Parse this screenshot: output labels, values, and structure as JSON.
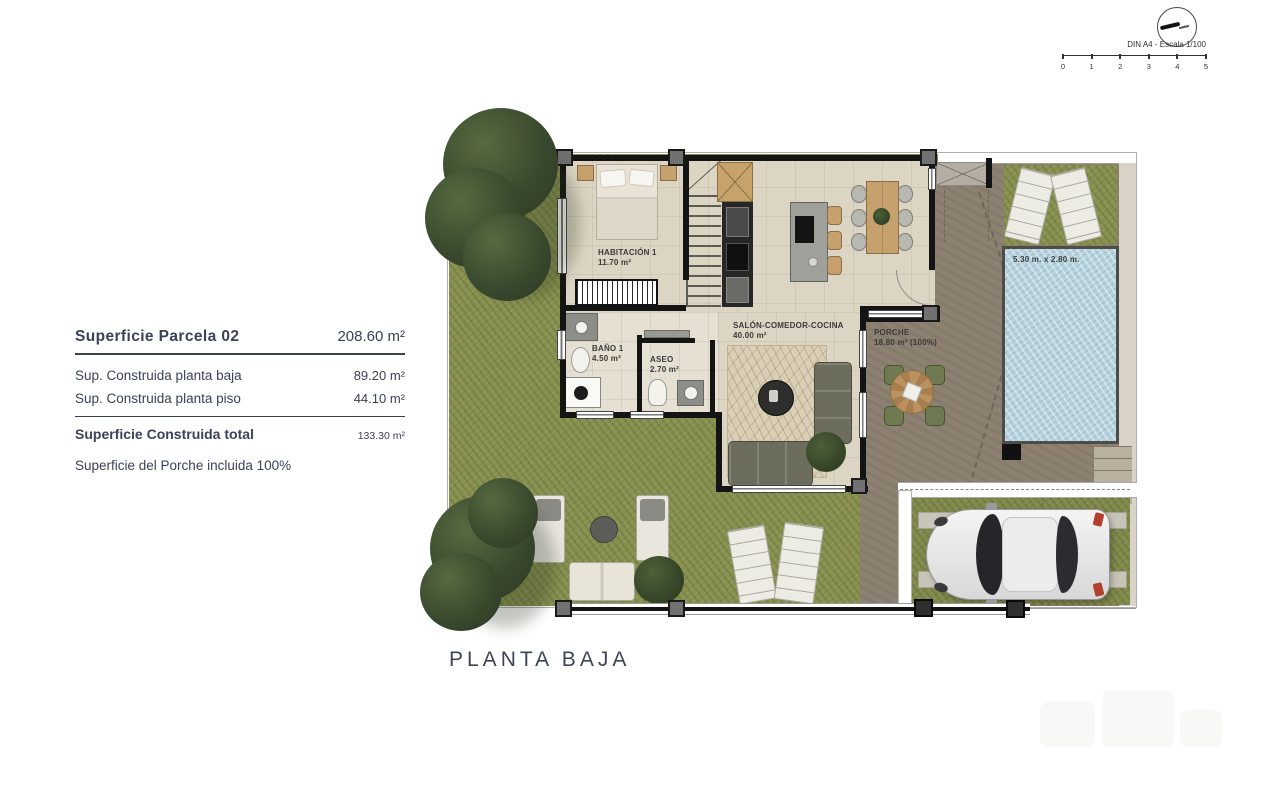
{
  "header": {
    "din_label": "DIN A4 - Escala 1/100",
    "ticks": [
      "0",
      "1",
      "2",
      "3",
      "4",
      "5"
    ]
  },
  "info_panel": {
    "title": {
      "label": "Superficie Parcela 02",
      "value": "208.60 m²"
    },
    "rows": [
      {
        "label": "Sup. Construida planta baja",
        "value": "89.20 m²"
      },
      {
        "label": "Sup. Construida planta piso",
        "value": "44.10 m²"
      }
    ],
    "total": {
      "label": "Superficie Construida total",
      "value": "133.30 m²"
    },
    "note": "Superficie del Porche incluida 100%"
  },
  "plan": {
    "title": "PLANTA BAJA",
    "rooms": [
      {
        "name": "HABITACIÓN 1",
        "area": "11.70 m²"
      },
      {
        "name": "BAÑO 1",
        "area": "4.50 m²"
      },
      {
        "name": "ASEO",
        "area": "2.70 m²"
      },
      {
        "name": "SALÓN-COMEDOR-COCINA",
        "area": "40.00 m²"
      },
      {
        "name": "PORCHE",
        "area": "18.80 m² (100%)"
      }
    ],
    "pool": {
      "dimensions": "5.30 m. x 2.80 m."
    }
  },
  "colors": {
    "grass": "#87904f",
    "terrace": "#8d8172",
    "floor": "#ddd5c4",
    "pool_water": "#b6d2dc",
    "wall": "#141414",
    "text": "#3a4257"
  }
}
